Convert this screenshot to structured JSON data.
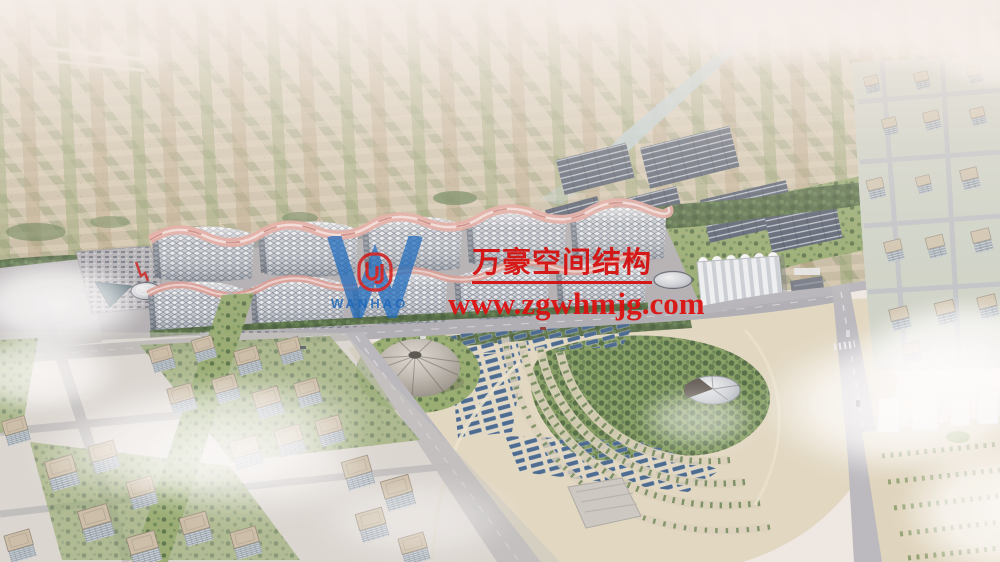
{
  "watermark": {
    "company": "万豪空间结构",
    "website": "www.zgwhmjg.com",
    "logo_text": "WANHAO"
  },
  "colors": {
    "watermark_red": "#d61010",
    "logo_blue": "#1e66b8",
    "emblem_red": "#d41414",
    "sky_haze": "#f5efeb",
    "farmland": "#c8bda4",
    "treeline": "#49643a",
    "lawn": "#90a768",
    "road": "#aaaab0",
    "hall_roof": "#e9edf2",
    "hall_grid": "#737c89",
    "ridge_pink": "#e2a49b",
    "park_sand": "#e0d7c0",
    "solar_slate": "#4b5668",
    "solar_blue": "#3c5f88",
    "dome_gray": "#b5b0a8",
    "water": "#46626f",
    "building_face": "#93a0ab",
    "building_roof": "#c8baa3",
    "station_white": "#eef1f4"
  }
}
